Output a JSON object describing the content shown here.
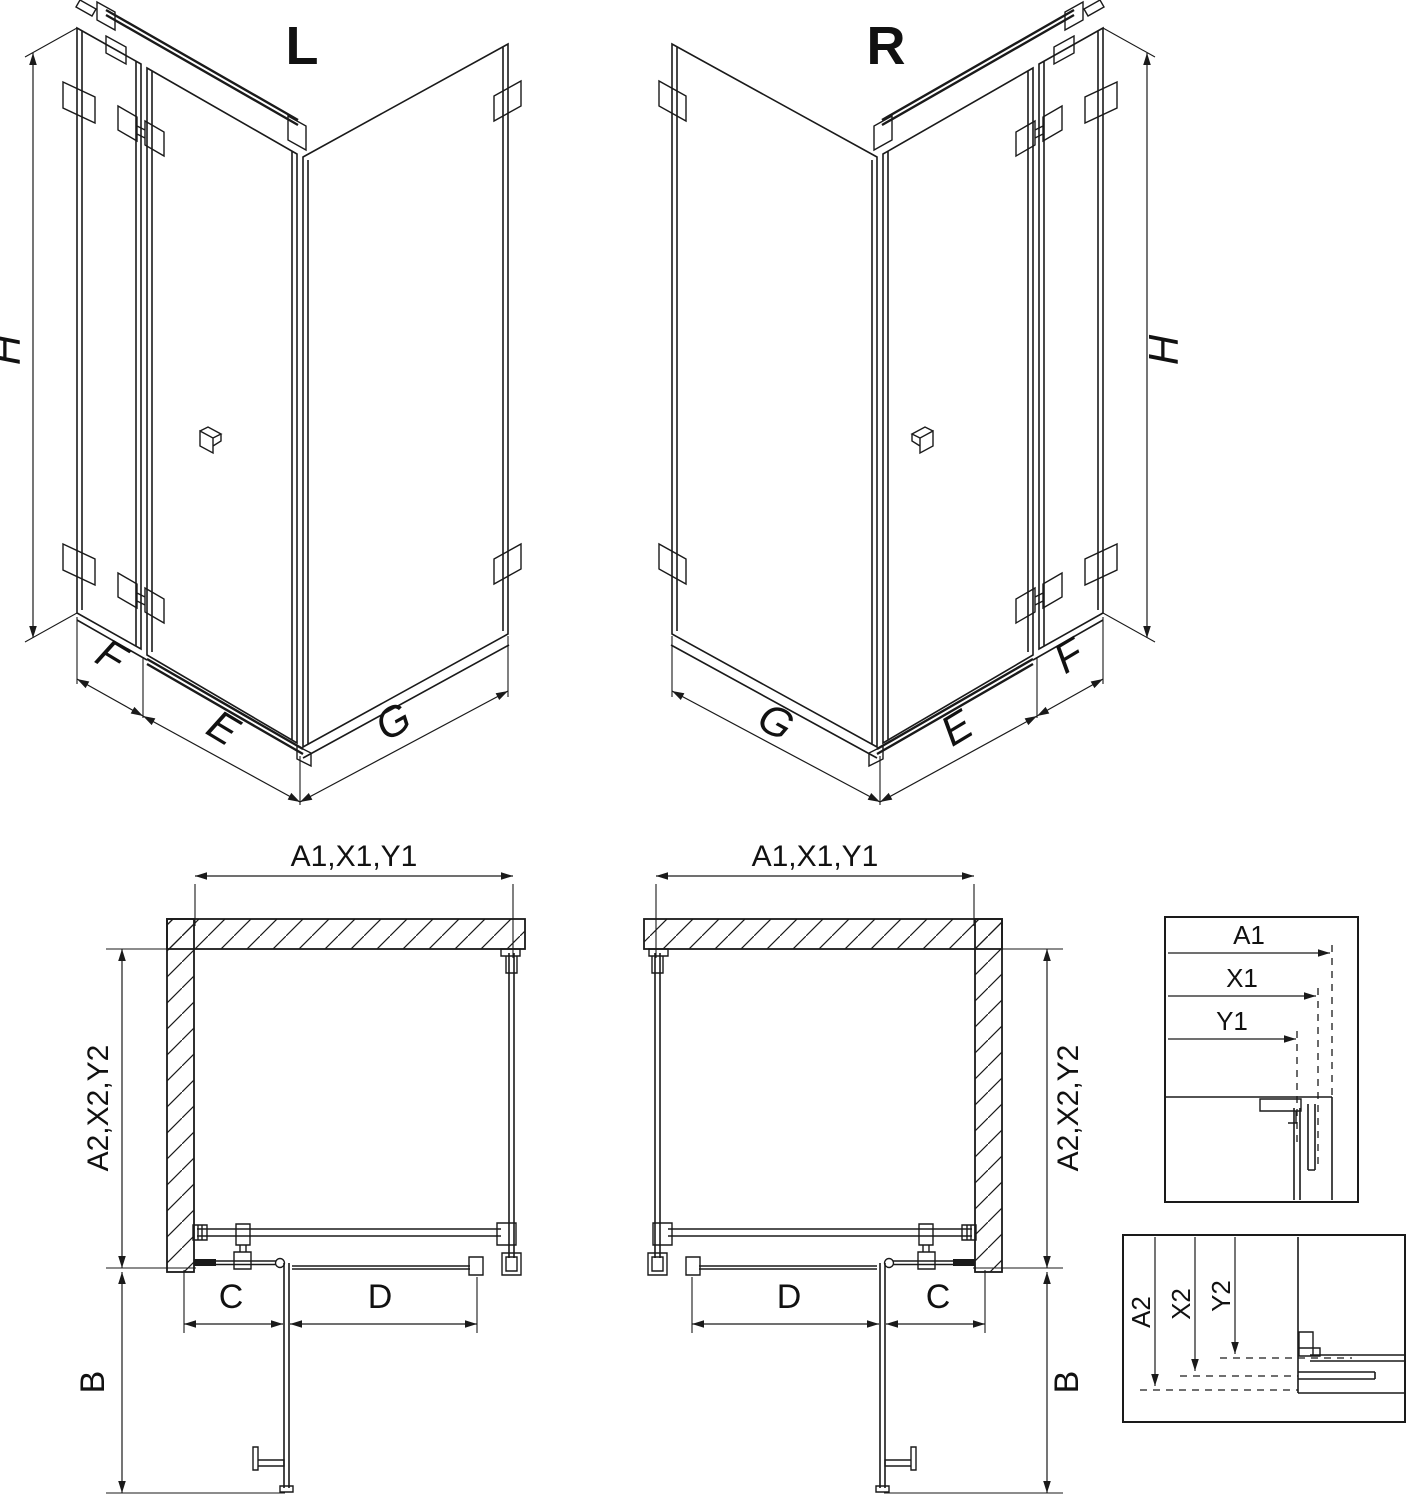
{
  "colors": {
    "line": "#1a1a1a",
    "bg": "#ffffff"
  },
  "iso_left": {
    "title": "L",
    "dim_height": "H",
    "dim_fixed": "F",
    "dim_door": "E",
    "dim_side": "G"
  },
  "iso_right": {
    "title": "R",
    "dim_height": "H",
    "dim_fixed": "F",
    "dim_door": "E",
    "dim_side": "G"
  },
  "plan_left": {
    "dim_width": "A1,X1,Y1",
    "dim_depth": "A2,X2,Y2",
    "dim_fixed": "C",
    "dim_door": "D",
    "dim_swing": "B"
  },
  "plan_right": {
    "dim_width": "A1,X1,Y1",
    "dim_depth": "A2,X2,Y2",
    "dim_fixed": "C",
    "dim_door": "D",
    "dim_swing": "B"
  },
  "detail_width": {
    "dims": [
      "A1",
      "X1",
      "Y1"
    ]
  },
  "detail_depth": {
    "dims": [
      "A2",
      "X2",
      "Y2"
    ]
  }
}
